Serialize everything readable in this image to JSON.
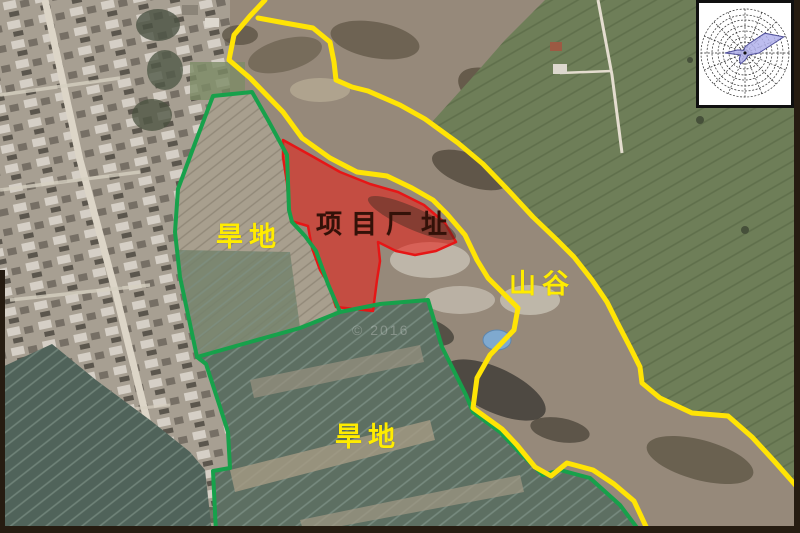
{
  "labels": {
    "project_site": {
      "text": "项目厂址",
      "color": "#331108"
    },
    "dryland_upper": {
      "text": "旱地",
      "color": "#ffec00"
    },
    "dryland_lower": {
      "text": "旱地",
      "color": "#ffec00"
    },
    "valley": {
      "text": "山谷",
      "color": "#ffec00"
    }
  },
  "watermark": {
    "text": "© 2016"
  },
  "overlays": {
    "site_fill": "rgba(235,28,20,0.55)",
    "site_boundary_color": "#e61616",
    "parcel_boundary_color": "#17a14b",
    "valley_route_color": "#ffe405"
  },
  "windrose": {
    "kind": "wind-rose-inset",
    "directions": 16,
    "values": [
      6,
      10,
      28,
      42,
      14,
      5,
      4,
      5,
      7,
      12,
      8,
      5,
      20,
      8,
      4,
      3
    ],
    "rings": 8,
    "fill": "#b2b2ec",
    "stroke": "#50509a"
  }
}
